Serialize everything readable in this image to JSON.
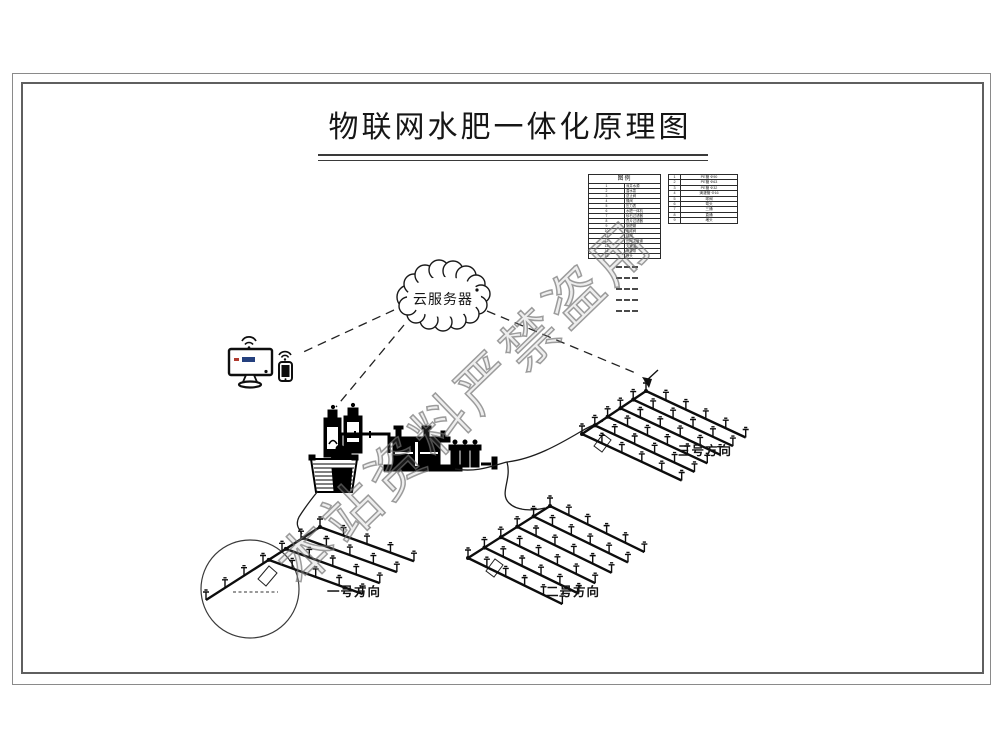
{
  "title": "物联网水肥一体化原理图",
  "cloud": {
    "label": "云服务器"
  },
  "legend": {
    "header": "图例",
    "left_rows": [
      [
        "1",
        "深井水源"
      ],
      [
        "2",
        "潜水泵"
      ],
      [
        "3",
        "逆止阀"
      ],
      [
        "4",
        "蝶阀"
      ],
      [
        "5",
        "压力表"
      ],
      [
        "6",
        "水肥一体机"
      ],
      [
        "7",
        "砂石过滤器"
      ],
      [
        "8",
        "叠片过滤器"
      ],
      [
        "9",
        "施肥罐"
      ],
      [
        "10",
        "电磁阀"
      ],
      [
        "11",
        "球阀"
      ],
      [
        "12",
        "田间主管道"
      ],
      [
        "13",
        "支管道"
      ],
      [
        "14",
        "滴灌带"
      ],
      [
        "15",
        "喷头"
      ]
    ],
    "right_rows": [
      [
        "1",
        "PE管 Φ90"
      ],
      [
        "2",
        "PE管 Φ63"
      ],
      [
        "3",
        "PE管 Φ32"
      ],
      [
        "4",
        "滴灌管 Φ16"
      ],
      [
        "5",
        "球阀"
      ],
      [
        "6",
        "弯头"
      ],
      [
        "7",
        "三通"
      ],
      [
        "8",
        "直通"
      ],
      [
        "9",
        "堵头"
      ]
    ],
    "note_count": 5
  },
  "fields": [
    {
      "label": "一号方向"
    },
    {
      "label": "二号方向"
    },
    {
      "label": "三号方向"
    }
  ],
  "watermark": {
    "text": "本站资料严禁盗用",
    "color": "#8a8a8a"
  },
  "colors": {
    "line": "#1a1a1a",
    "frame": "#777777",
    "screen_red": "#b03a2e",
    "screen_blue": "#24407e"
  }
}
